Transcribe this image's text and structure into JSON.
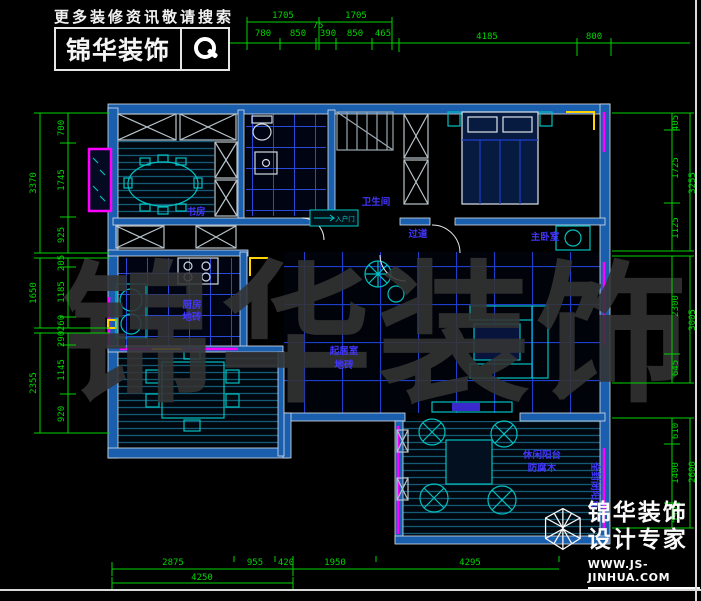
{
  "branding": {
    "tagline": "更多装修资讯敬请搜索",
    "logo": "锦华装饰",
    "footer_line1": "锦华装饰",
    "footer_line2": "设计专家",
    "footer_url": "WWW.JS-JINHUA.COM"
  },
  "watermark": "锦华装饰",
  "labels": {
    "study": "书房",
    "bathroom": "卫生间",
    "hallway": "过道",
    "master_bedroom": "主卧室",
    "kitchen": "厨房",
    "kitchen_floor": "地砖",
    "living": "起居室",
    "living_floor": "地砖",
    "balcony_line1": "休闲阳台",
    "balcony_line2": "防腐木",
    "side_balcony": "全封闭阳台",
    "entry_note": "入户门"
  },
  "dims": {
    "top_outer": [
      "1705",
      "1705"
    ],
    "top_inner": [
      "780",
      "850",
      "75",
      "390",
      "850",
      "465"
    ],
    "top_right": [
      "4185",
      "800"
    ],
    "bottom_row1": [
      "2875",
      "955",
      "420",
      "1950",
      "4295"
    ],
    "bottom_row2": [
      "4250"
    ],
    "left_g1": [
      "700",
      "1745",
      "925",
      "3370"
    ],
    "left_g2": [
      "205",
      "1185",
      "260",
      "1650"
    ],
    "left_g3": [
      "290",
      "1145",
      "920",
      "2355"
    ],
    "right_g1": [
      "405",
      "1725",
      "1125",
      "3255"
    ],
    "right_g2": [
      "2300",
      "645",
      "3005"
    ],
    "right_g3": [
      "610",
      "1400",
      "590",
      "2600"
    ]
  },
  "colors": {
    "dimension_green": "#00d400",
    "wall_blue": "#1a5fae",
    "window_magenta": "#ff00ff",
    "furniture_cyan": "#00c0c0",
    "label_purple": "#4336ff",
    "door_yellow": "#ffd400"
  }
}
